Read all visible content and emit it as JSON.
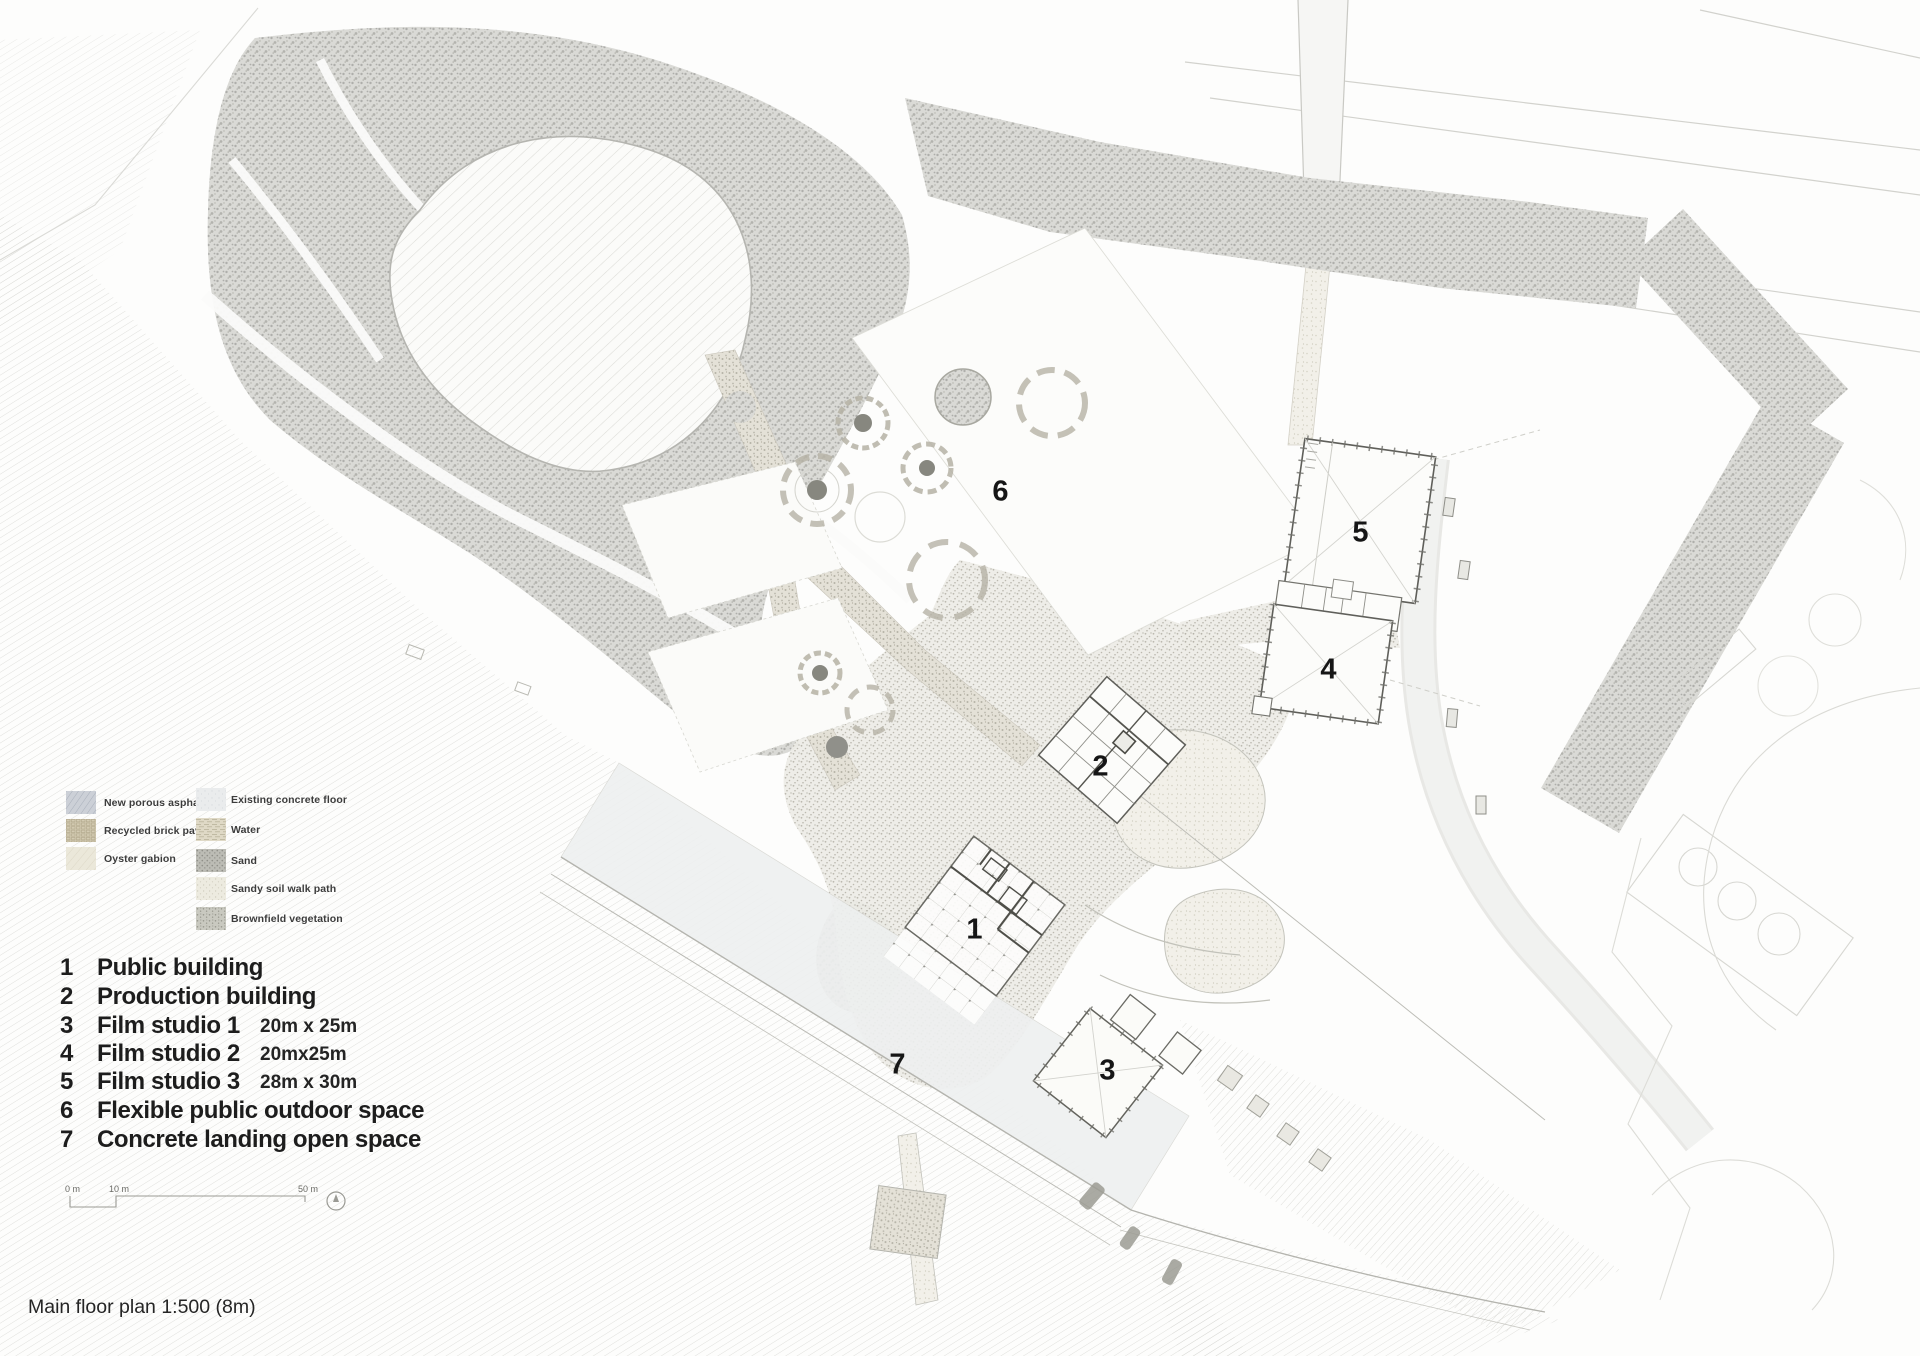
{
  "title": "Main floor plan 1:500 (8m)",
  "legend": {
    "items": [
      {
        "label": "New porous asphalt",
        "color": "#ccd0d7"
      },
      {
        "label": "Recycled brick paving",
        "color": "#d3cbb2"
      },
      {
        "label": "Oyster gabion",
        "color": "#ebe8da"
      },
      {
        "label": "Existing concrete floor",
        "color": "#eaeced"
      },
      {
        "label": "Water",
        "color": "#dfd9c6"
      },
      {
        "label": "Sand",
        "color": "#bcbcb5"
      },
      {
        "label": "Sandy soil walk path",
        "color": "#edebe0"
      },
      {
        "label": "Brownfield vegetation",
        "color": "#c9c9c0"
      }
    ]
  },
  "key_list": {
    "items": [
      {
        "num": "1",
        "label": "Public building",
        "detail": ""
      },
      {
        "num": "2",
        "label": "Production building",
        "detail": ""
      },
      {
        "num": "3",
        "label": "Film studio 1",
        "detail": "20m x 25m"
      },
      {
        "num": "4",
        "label": "Film studio 2",
        "detail": "20mx25m"
      },
      {
        "num": "5",
        "label": "Film studio 3",
        "detail": "28m x 30m"
      },
      {
        "num": "6",
        "label": "Flexible public outdoor space",
        "detail": ""
      },
      {
        "num": "7",
        "label": "Concrete landing open space",
        "detail": ""
      }
    ]
  },
  "plan_labels": [
    "1",
    "2",
    "3",
    "4",
    "5",
    "6",
    "7"
  ],
  "scale_bar": {
    "labels": [
      "0 m",
      "10 m",
      "50 m"
    ]
  },
  "colors": {
    "ink": "#1d1d1d",
    "pencil_dark": "#8c8c86",
    "pencil_light": "#d6d6d2",
    "building_stroke": "#5f5f5a",
    "paper": "#fdfdfc"
  }
}
